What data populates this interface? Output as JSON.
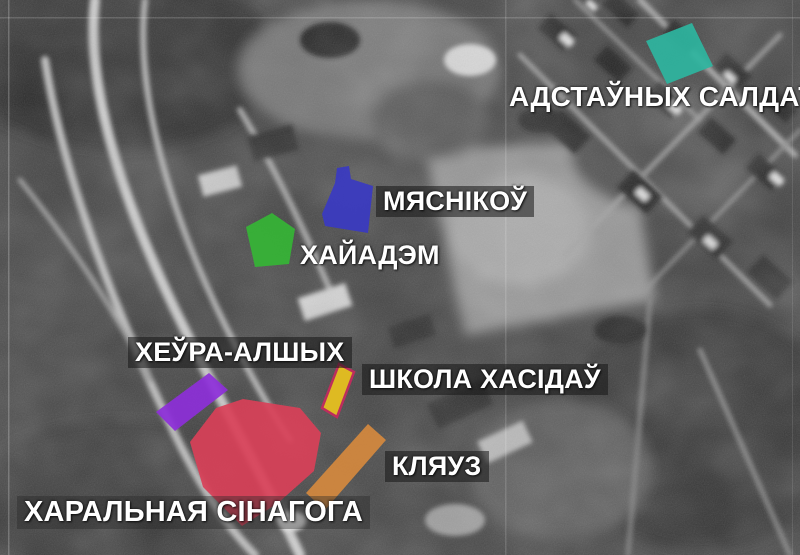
{
  "map": {
    "description_labels_language": "Belarusian",
    "buildings": [
      {
        "id": "adstaunych-saldat",
        "label": "АДСТАЎНЫХ САЛДАТ",
        "color": "#2eb5a0"
      },
      {
        "id": "miasnikou",
        "label": "МЯСНІКОЎ",
        "color": "#3a3ac2"
      },
      {
        "id": "chajadem",
        "label": "ХАЙАДЭМ",
        "color": "#35b535"
      },
      {
        "id": "cheura-alshych",
        "label": "ХЕЎРА-АЛШЫХ",
        "color": "#8d2fd9"
      },
      {
        "id": "shkola-chasidau",
        "label": "ШКОЛА ХАСІДАЎ",
        "color": "#eac31e",
        "border_color": "#c62a5e"
      },
      {
        "id": "klauz",
        "label": "КЛЯУЗ",
        "color": "#d5893e"
      },
      {
        "id": "charalnaja-sinahoha",
        "label": "ХАРАЛЬНАЯ СІНАГОГА",
        "color": "#d94058"
      }
    ]
  }
}
